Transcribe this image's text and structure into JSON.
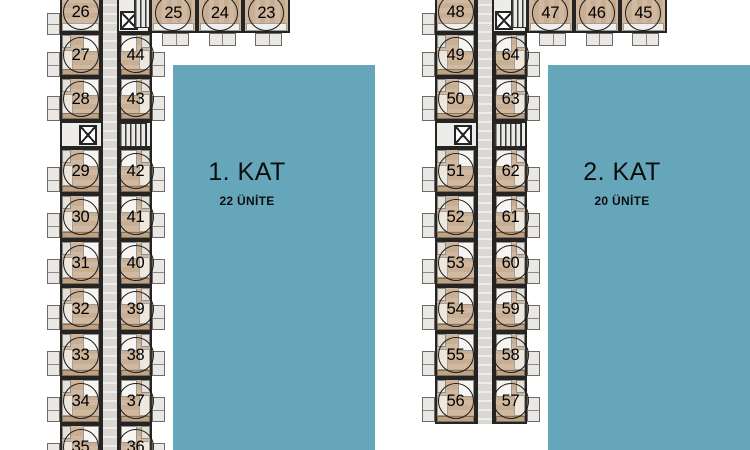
{
  "palette": {
    "background": "#ffffff",
    "panel_teal": "#66a6ba",
    "wall": "#242424",
    "wood_floor": "#cbae92",
    "corridor": "#dbd8d3",
    "balcony": "#eae8e4",
    "bathroom": "#f6f5f2"
  },
  "floors": [
    {
      "panel": {
        "title": "1. KAT",
        "subtitle": "22 ÜNİTE"
      },
      "top_unit": "26",
      "wing_units": [
        "25",
        "24",
        "23"
      ],
      "rows": [
        {
          "left": "27",
          "right": "44"
        },
        {
          "left": "28",
          "right": "43"
        },
        {
          "core": true
        },
        {
          "left": "29",
          "right": "42"
        },
        {
          "left": "30",
          "right": "41"
        },
        {
          "left": "31",
          "right": "40"
        },
        {
          "left": "32",
          "right": "39"
        },
        {
          "left": "33",
          "right": "38"
        },
        {
          "left": "34",
          "right": "37"
        },
        {
          "left": "35",
          "right": "36"
        }
      ]
    },
    {
      "panel": {
        "title": "2. KAT",
        "subtitle": "20 ÜNİTE"
      },
      "top_unit": "48",
      "wing_units": [
        "47",
        "46",
        "45"
      ],
      "rows": [
        {
          "left": "49",
          "right": "64"
        },
        {
          "left": "50",
          "right": "63"
        },
        {
          "core": true
        },
        {
          "left": "51",
          "right": "62"
        },
        {
          "left": "52",
          "right": "61"
        },
        {
          "left": "53",
          "right": "60"
        },
        {
          "left": "54",
          "right": "59"
        },
        {
          "left": "55",
          "right": "58"
        },
        {
          "left": "56",
          "right": "57"
        }
      ]
    }
  ]
}
